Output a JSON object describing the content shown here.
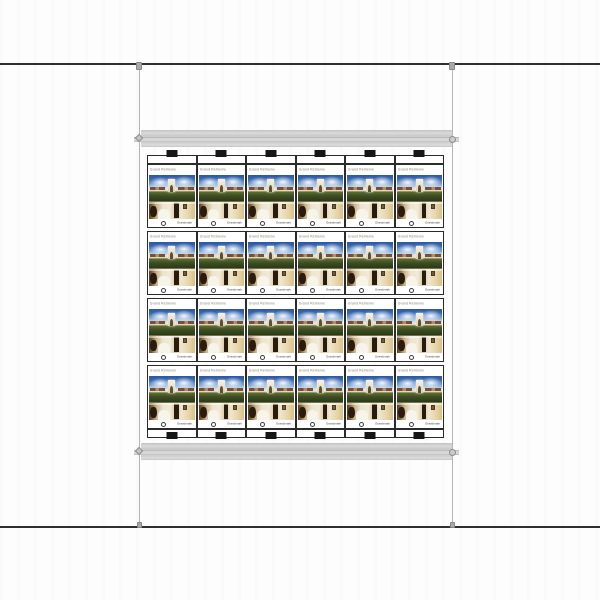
{
  "canvas": {
    "background": "#fdfdfd",
    "rule_line_color": "#2f2f2f",
    "guide_line_color": "#b5b5b5",
    "handle_color": "#a9a9a9"
  },
  "rails": {
    "count": 2,
    "color": "#d0d0d0",
    "positions": [
      "above-sheet",
      "below-sheet"
    ]
  },
  "sheet": {
    "columns": 6,
    "rows": 4,
    "registration_tab_color": "#161616",
    "card_border_color": "#2b2b2b",
    "card": {
      "title": "Grand Retirement Village",
      "title_color": "#8b8172",
      "logo_text": "Grandmark",
      "photo_exterior": "building-with-arch-tower-blue-sky-lawn",
      "photo_interior": "warm-toned-room-with-bed-and-dark-cabinet",
      "palette": {
        "sky": "#2a57a0",
        "grass": "#3c4d21",
        "building": "#efe8d6",
        "roof": "#7c4e37",
        "interior_wall": "#ece4cf",
        "interior_dark": "#281c0f"
      }
    }
  }
}
